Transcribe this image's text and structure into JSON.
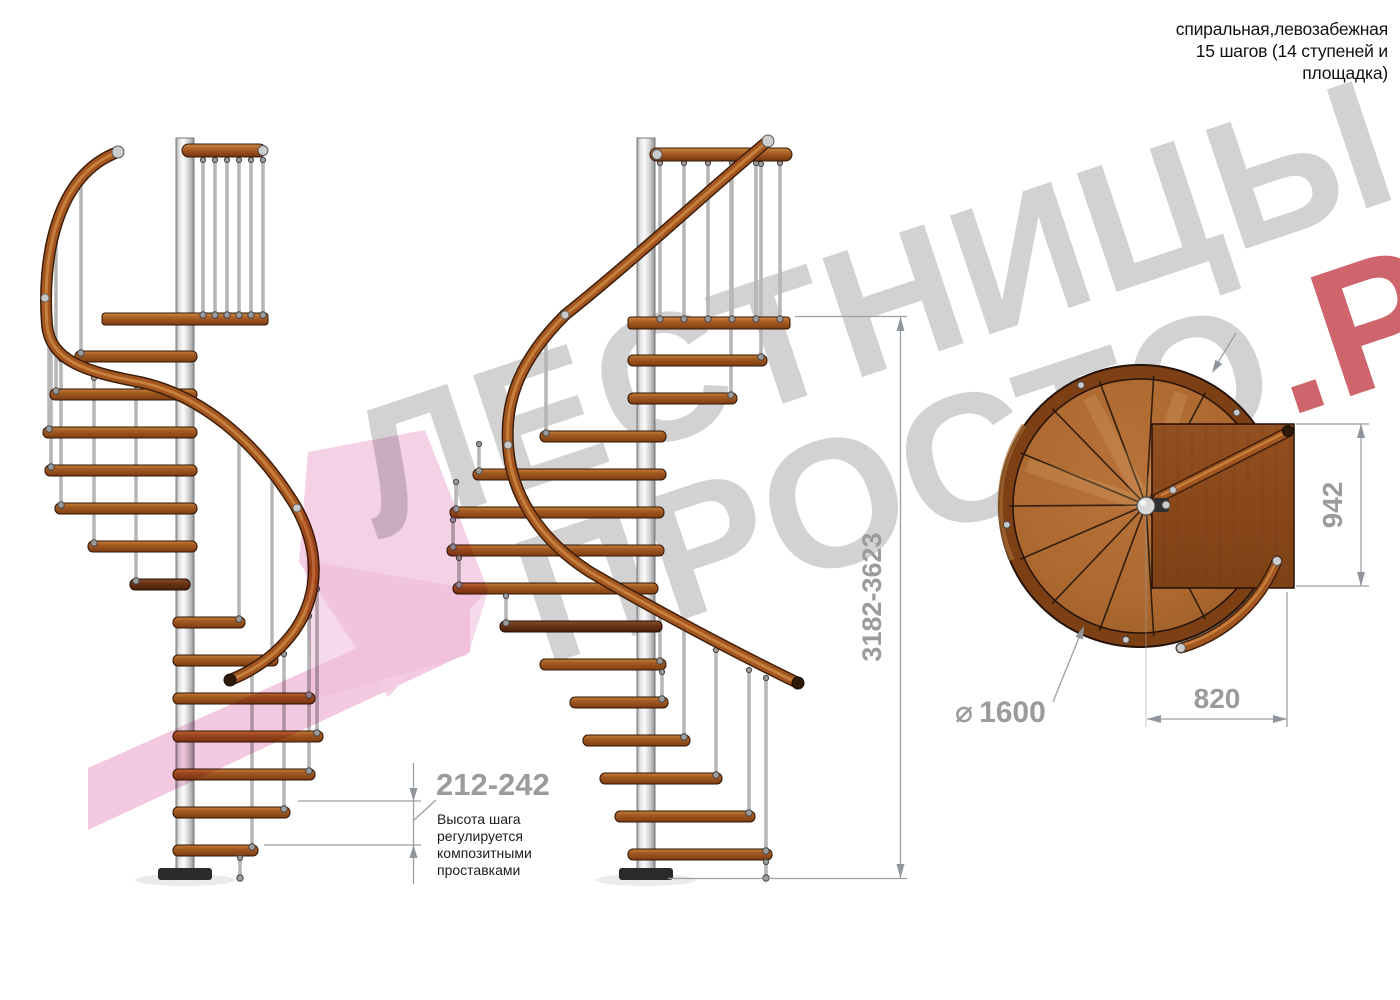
{
  "title": {
    "line1": "спиральная,левозабежная",
    "line2": "15 шагов (14 ступеней и",
    "line3": "площадка)"
  },
  "watermark": {
    "line1": "ЛЕСТНИЦЫ",
    "line2_gray": "ПРОСТО",
    "line2_red": ".РУ",
    "gray_color": "#d2d2d2",
    "red_color": "#c4434b",
    "pink_color": "#f2c3de"
  },
  "dims": {
    "total_height": "3182-3623",
    "step_pitch": "212-242",
    "landing_width": "942",
    "landing_depth": "820",
    "diameter_symbol": "⌀",
    "diameter_value": "1600"
  },
  "note": {
    "l1": "Высота шага",
    "l2": "регулируется",
    "l3": "композитными",
    "l4": "проставками"
  },
  "colors": {
    "wood": "#ad6930",
    "wood_dark": "#7d4015",
    "metal": "#c9c9c9",
    "dim_gray": "#9b9b9b"
  }
}
